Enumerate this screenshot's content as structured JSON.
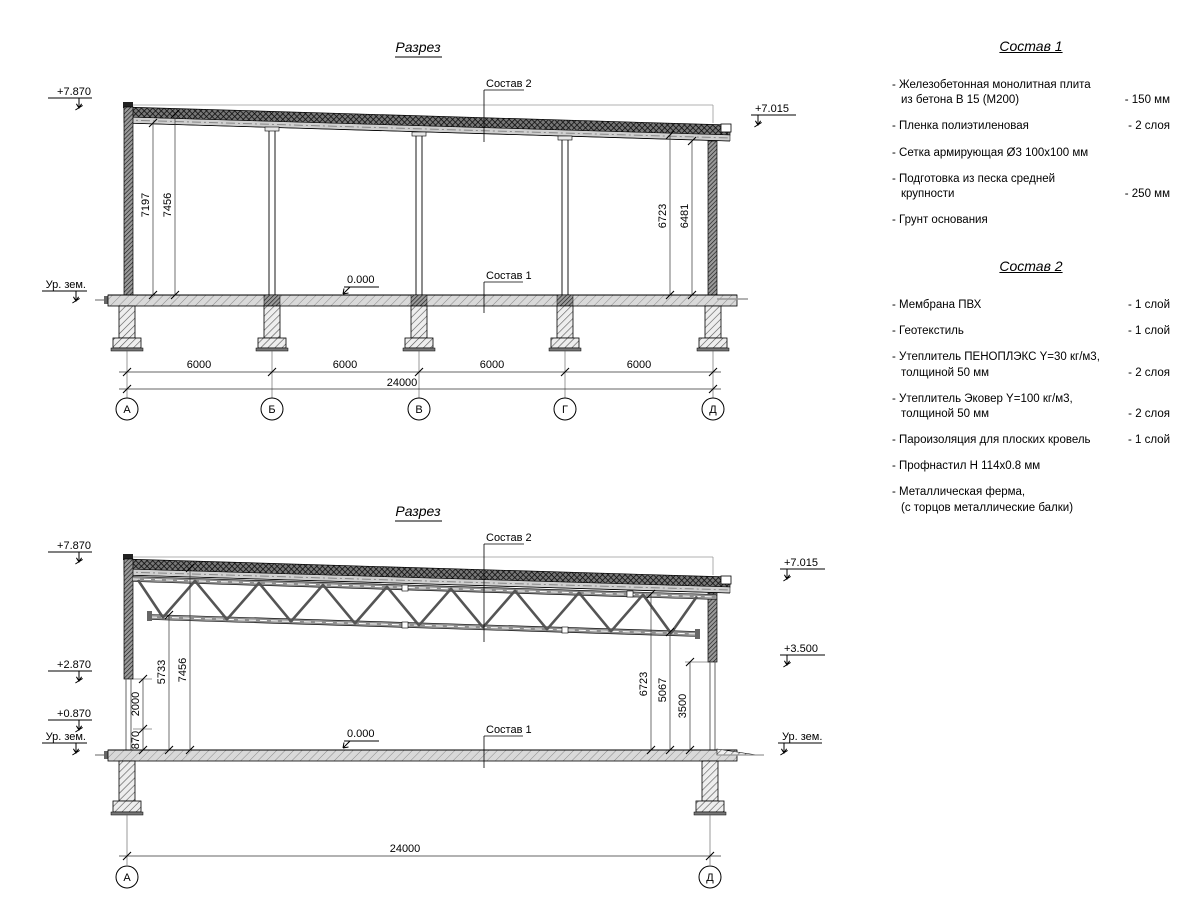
{
  "section1": {
    "title": "Разрез",
    "zero": "0.000",
    "callout1": "Состав 1",
    "callout2": "Состав 2",
    "elev_top_left": "+7.870",
    "elev_top_right": "+7.015",
    "ground_left": "Ур. зем.",
    "vdims": {
      "left_inner": "7197",
      "left_outer": "7456",
      "right_inner": "6723",
      "right_outer": "6481"
    },
    "bays": [
      "6000",
      "6000",
      "6000",
      "6000"
    ],
    "total": "24000",
    "axes": [
      "А",
      "Б",
      "В",
      "Г",
      "Д"
    ]
  },
  "section2": {
    "title": "Разрез",
    "zero": "0.000",
    "callout1": "Состав 1",
    "callout2": "Состав 2",
    "elev_top_left": "+7.870",
    "elev_mid_left": "+2.870",
    "elev_low_left": "+0.870",
    "ground_left": "Ур. зем.",
    "elev_top_right": "+7.015",
    "elev_mid_right": "+3.500",
    "ground_right": "Ур. зем.",
    "vdims": {
      "d870": "870",
      "d2000": "2000",
      "d5733": "5733",
      "d7456": "7456",
      "d6723": "6723",
      "d5067": "5067",
      "d3500": "3500"
    },
    "total": "24000",
    "axes": [
      "А",
      "Д"
    ]
  },
  "sostav1": {
    "title": "Состав 1",
    "items": [
      {
        "name": "- Железобетонная  монолитная плита\nиз бетона В 15 (М200)",
        "value": "- 150 мм"
      },
      {
        "name": "- Пленка полиэтиленовая",
        "value": "-  2 слоя"
      },
      {
        "name": "- Сетка армирующая Ø3 100х100 мм",
        "value": ""
      },
      {
        "name": "- Подготовка из песка средней\nкрупности",
        "value": "- 250 мм"
      },
      {
        "name": "- Грунт основания",
        "value": ""
      }
    ]
  },
  "sostav2": {
    "title": "Состав 2",
    "items": [
      {
        "name": "- Мембрана ПВХ",
        "value": "- 1 слой"
      },
      {
        "name": "- Геотекстиль",
        "value": "- 1 слой"
      },
      {
        "name": "- Утеплитель ПЕНОПЛЭКС Y=30 кг/м3,\nтолщиной 50 мм",
        "value": "- 2 слоя"
      },
      {
        "name": "- Утеплитель Эковер Y=100 кг/м3,\nтолщиной 50 мм",
        "value": "- 2 слоя"
      },
      {
        "name": "- Пароизоляция для плоских кровель",
        "value": "- 1 слой"
      },
      {
        "name": "- Профнастил Н 114х0.8 мм",
        "value": ""
      },
      {
        "name": "- Металлическая ферма,\n(с торцов металлические балки)",
        "value": ""
      }
    ]
  }
}
